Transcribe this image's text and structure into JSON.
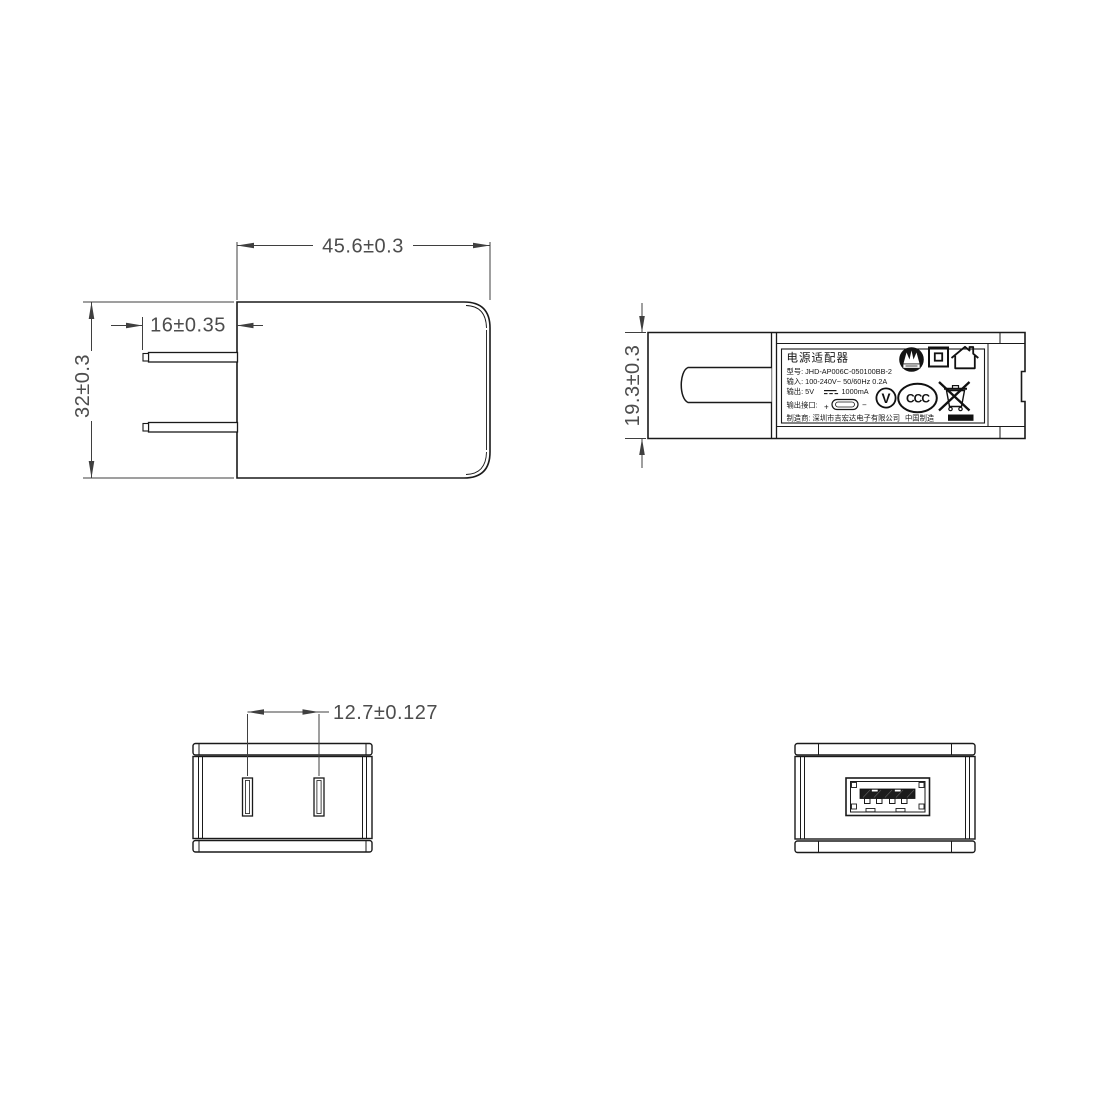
{
  "drawing": {
    "background_color": "#ffffff",
    "line_color": "#1a1a1a",
    "dimension_color": "#4d4d4d",
    "dimensions": {
      "body_width": "45.6±0.3",
      "body_height": "32±0.3",
      "prong_length": "16±0.35",
      "body_thickness": "19.3±0.3",
      "prong_spacing": "12.7±0.127"
    },
    "label": {
      "title": "电源适配器",
      "model": "型号: JHD-AP006C-050100BB-2",
      "input": "输入: 100-240V~  50/60Hz  0.2A",
      "output_prefix": "输出: 5V",
      "output_suffix": "1000mA",
      "port_label": "输出接口:",
      "plus": "+",
      "minus": "−",
      "manufacturer": "制造商: 深圳市吉宏达电子有限公司",
      "made_in": "中国制造",
      "efficiency_mark": "V",
      "ccc_mark": "CCC"
    }
  }
}
